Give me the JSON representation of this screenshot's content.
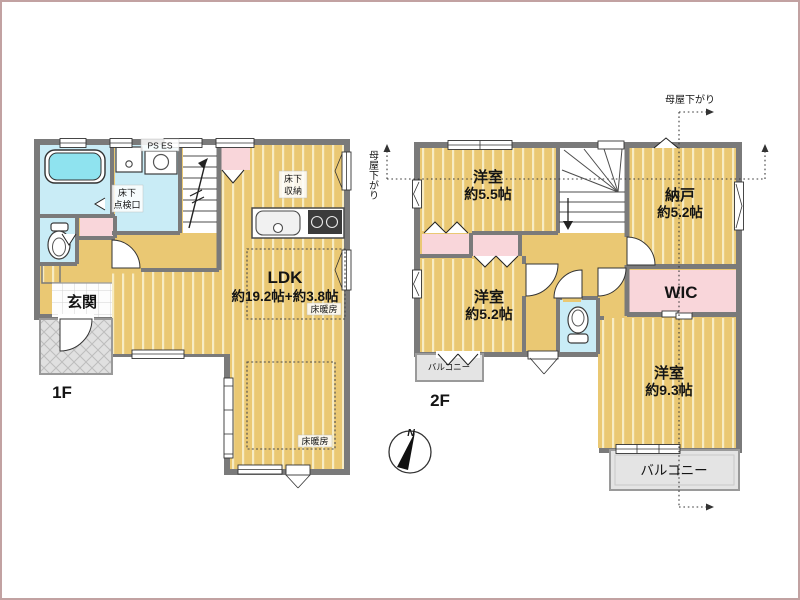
{
  "floor1": {
    "floor_label": "1F",
    "entrance": "玄関",
    "ldk_name": "LDK",
    "ldk_size": "約19.2帖+約3.8帖",
    "floor_heating_upper": "床暖房",
    "floor_heating_lower": "床暖房",
    "underfloor_hatch": [
      "床下",
      "点検口"
    ],
    "underfloor_storage": [
      "床下",
      "収納"
    ],
    "pipe_space": "PS ES"
  },
  "floor2": {
    "floor_label": "2F",
    "room_top_left_name": "洋室",
    "room_top_left_size": "約5.5帖",
    "storage_room_name": "納戸",
    "storage_room_size": "約5.2帖",
    "room_mid_left_name": "洋室",
    "room_mid_left_size": "約5.2帖",
    "wic": "WIC",
    "room_bottom_right_name": "洋室",
    "room_bottom_right_size": "約9.3帖",
    "balcony_left": "バルコニー",
    "balcony_bottom": "バルコニー"
  },
  "annotations": {
    "roof_lowered_top": "母屋下がり",
    "roof_lowered_left": "母屋下がり",
    "north": "N"
  },
  "colors": {
    "wall": "#7a7a7a",
    "floor_tan": "#eac873",
    "floor_stripe": "#f7ecc4",
    "wet_room_cyan": "#c9ecf6",
    "bathtub_cyan": "#8fe3ef",
    "closet_pink": "#f9d6da",
    "balcony_gray": "#e4e4e4",
    "porch_gray": "#e0e0e0",
    "page_border": "#c2a2a2"
  }
}
